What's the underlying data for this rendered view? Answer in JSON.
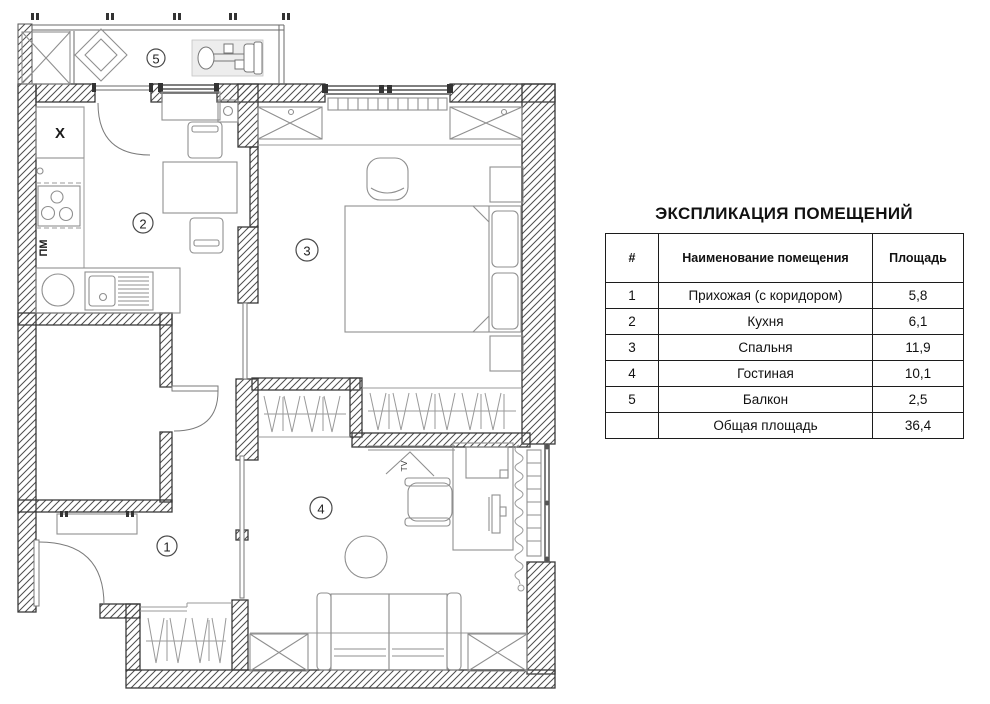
{
  "plan": {
    "room_numbers": {
      "hallway": "1",
      "kitchen": "2",
      "bedroom": "3",
      "living_room": "4",
      "balcony": "5"
    },
    "labels": {
      "fridge": "X",
      "dishwasher": "ПМ",
      "tv": "TV"
    },
    "colors": {
      "wall_line": "#3a3a3a",
      "furniture_line": "#8f8f8f",
      "hatch": "#4d4d4d",
      "background": "#ffffff"
    }
  },
  "table": {
    "title": "ЭКСПЛИКАЦИЯ ПОМЕЩЕНИЙ",
    "columns": [
      "#",
      "Наименование помещения",
      "Площадь"
    ],
    "rows": [
      {
        "num": "1",
        "name": "Прихожая (с коридором)",
        "area": "5,8"
      },
      {
        "num": "2",
        "name": "Кухня",
        "area": "6,1"
      },
      {
        "num": "3",
        "name": "Спальня",
        "area": "11,9"
      },
      {
        "num": "4",
        "name": "Гостиная",
        "area": "10,1"
      },
      {
        "num": "5",
        "name": "Балкон",
        "area": "2,5"
      }
    ],
    "total": {
      "num": "",
      "name": "Общая площадь",
      "area": "36,4"
    }
  }
}
